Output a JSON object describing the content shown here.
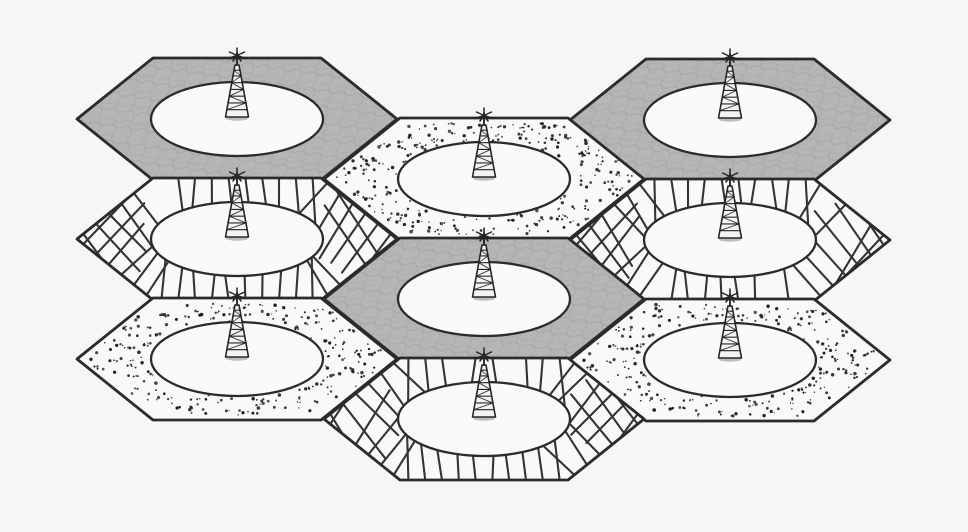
{
  "scene": {
    "type": "cellular-network-hexagon-diagram",
    "background": "#f7f6f4",
    "ink": "#2b2b2b",
    "colors": {
      "shaded_fill": "#b6b5b3",
      "shaded_texture": "#9a9a9a",
      "light_fill": "#faf9f7",
      "ellipse_fill": "#fbfaf8",
      "dot_color": "#1b1b1b",
      "hatch_color": "#343434",
      "tower_color": "#262626",
      "tower_fill": "#f4f3f1"
    },
    "geometry": {
      "canvas_w": 968,
      "canvas_h": 532,
      "hex_half_width": 160,
      "hex_top_half_width": 84,
      "hex_half_height": 61,
      "ellipse_rx": 86,
      "ellipse_ry": 37,
      "border_width": 2.8,
      "ellipse_stroke_width": 2.3,
      "hatch_spacing": 17,
      "hatch_length": 62,
      "hatch_width": 2.1,
      "dot_candidates": 560,
      "tower_height": 52,
      "tower_base_half_width": 11.5
    },
    "cells": [
      {
        "name": "cell-top-left",
        "cx": 237,
        "cy": 119,
        "pattern": "shaded"
      },
      {
        "name": "cell-mid-left",
        "cx": 237,
        "cy": 239,
        "pattern": "hatched"
      },
      {
        "name": "cell-bottom-left",
        "cx": 237,
        "cy": 359,
        "pattern": "dotted"
      },
      {
        "name": "cell-top-right",
        "cx": 730,
        "cy": 120,
        "pattern": "shaded"
      },
      {
        "name": "cell-mid-right",
        "cx": 730,
        "cy": 240,
        "pattern": "hatched"
      },
      {
        "name": "cell-bottom-right",
        "cx": 730,
        "cy": 360,
        "pattern": "dotted"
      },
      {
        "name": "cell-top-middle",
        "cx": 484,
        "cy": 179,
        "pattern": "dotted"
      },
      {
        "name": "cell-center",
        "cx": 484,
        "cy": 299,
        "pattern": "shaded"
      },
      {
        "name": "cell-bottom-middle",
        "cx": 484,
        "cy": 419,
        "pattern": "hatched"
      }
    ]
  }
}
